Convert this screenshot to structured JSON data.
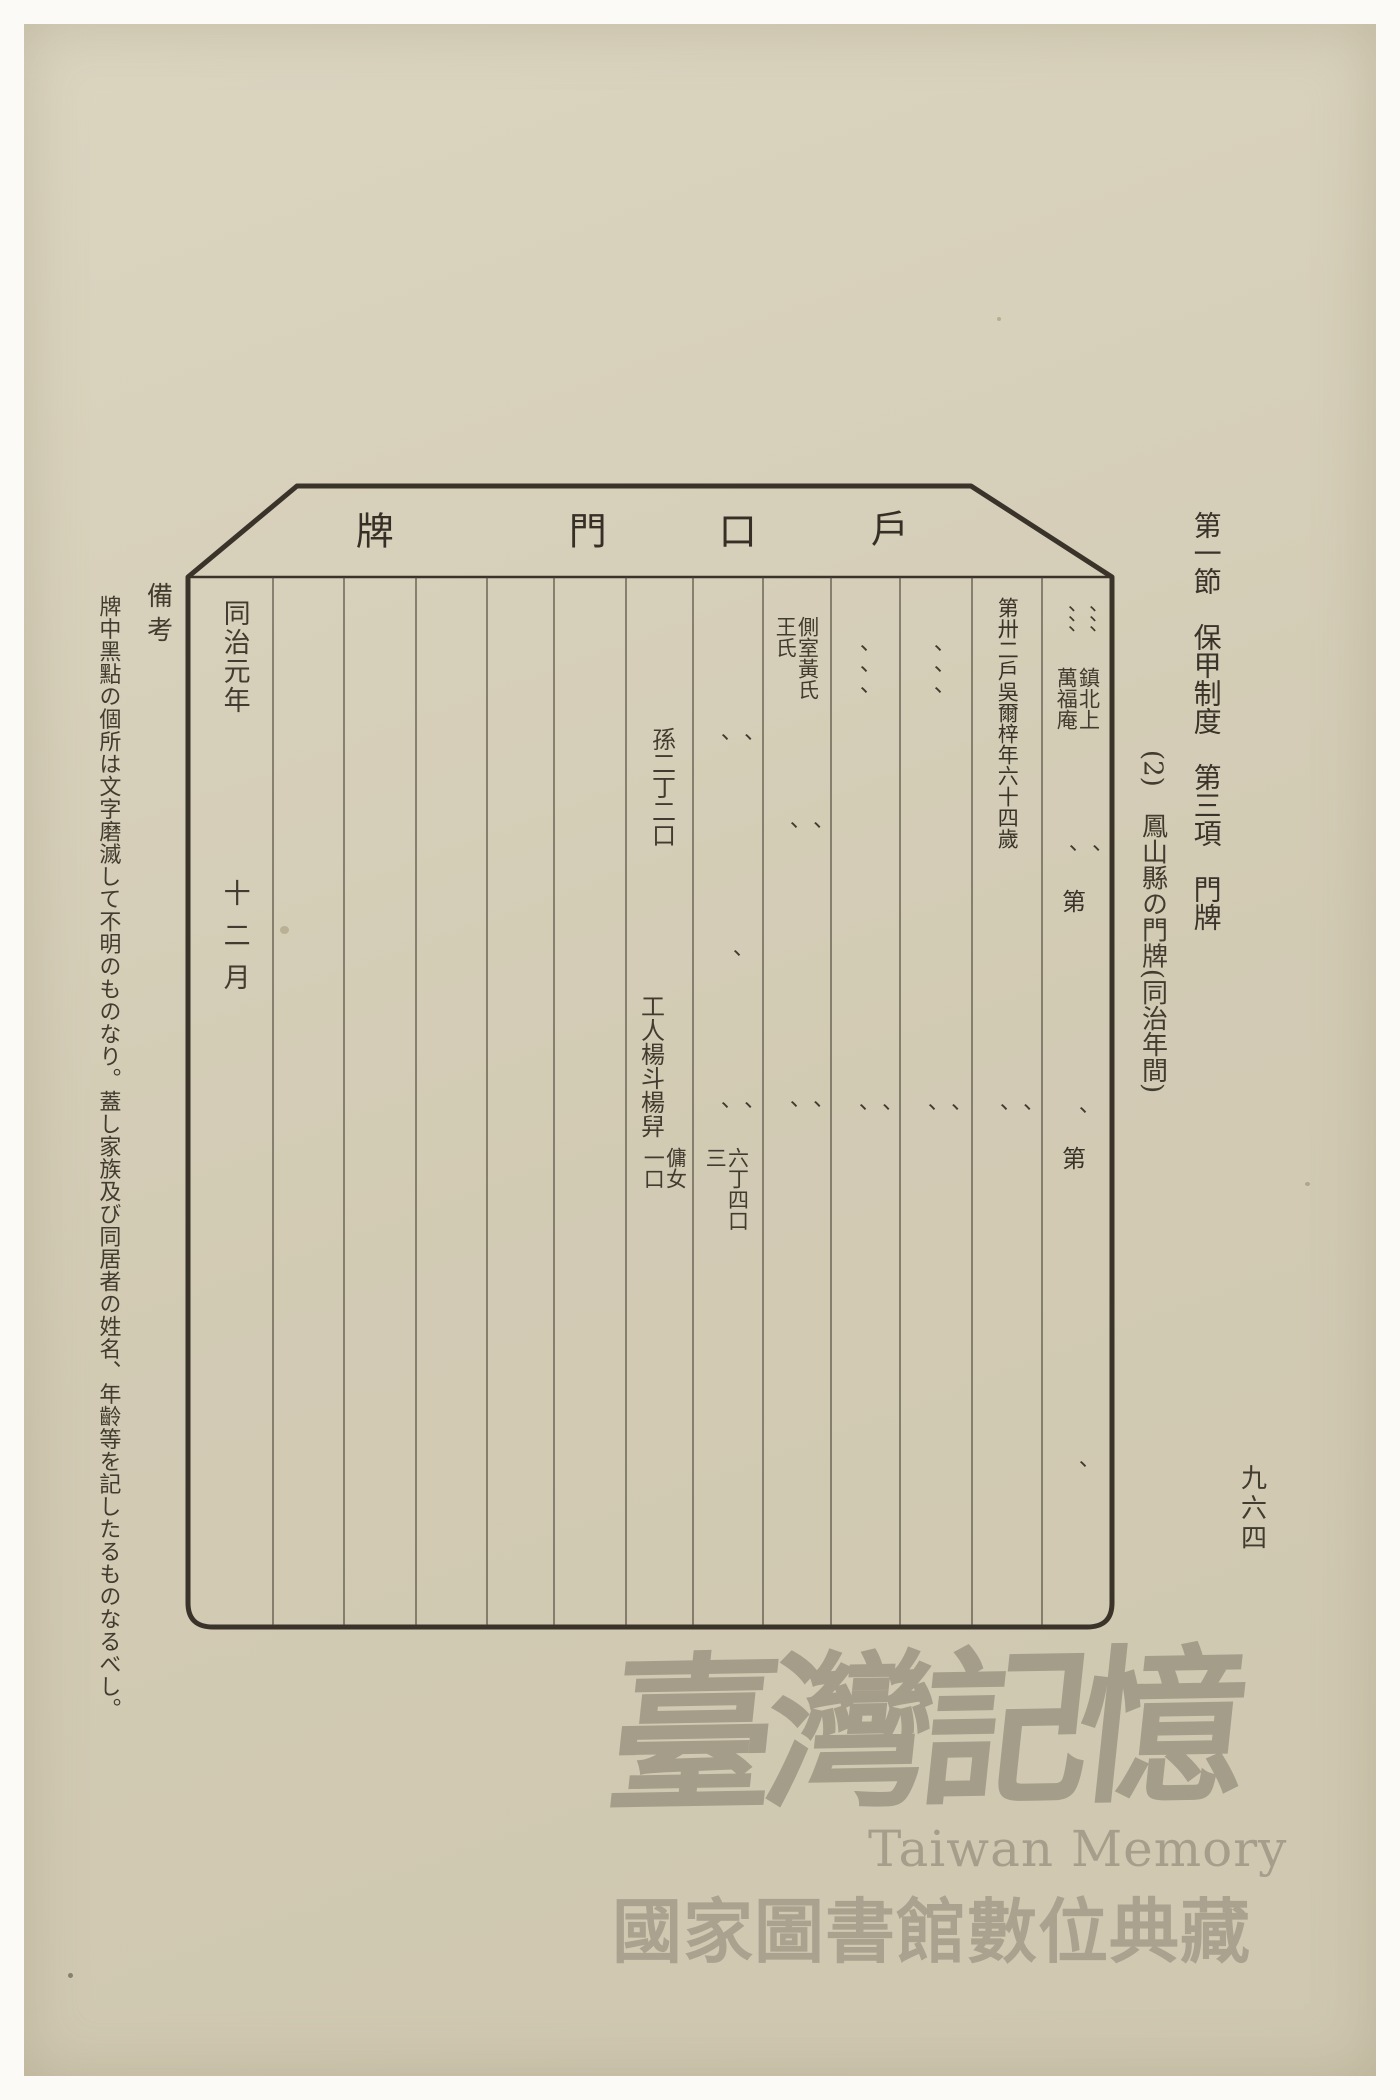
{
  "page": {
    "margin_header": "第一節　保甲制度　第三項　門牌",
    "section_title": "(2)　鳳山縣の門牌(同治年間)",
    "page_number": "九六四",
    "remarks_label": "備考",
    "remarks_text": "牌中黑點の個所は文字磨滅して不明のものなり。蓋し家族及び同居者の姓名、年齡等を記したるものなるべし。"
  },
  "plaque": {
    "title": {
      "c1": "牌",
      "c2": "門",
      "c3": "口",
      "c4": "戶"
    },
    "cells": {
      "era": "同治元年",
      "month": "十二月",
      "grandson": "孫二丁二口",
      "worker": "工人楊斗楊舁",
      "maid": "傭女\n一口",
      "total": "六丁四口\n三",
      "concubine": "側室黃氏\n王氏",
      "head": "第卅二戶吳爾梓年六十四歲",
      "address": "鎮北上\n萬福庵",
      "number_label": "第"
    },
    "marks": {
      "single": "、",
      "pair": "、\n、",
      "triple": "、、、",
      "six": "、、、\n、、、"
    }
  },
  "watermark": {
    "calligraphy": "臺灣記憶",
    "latin": "Taiwan Memory",
    "library": "國家圖書館數位典藏"
  }
}
